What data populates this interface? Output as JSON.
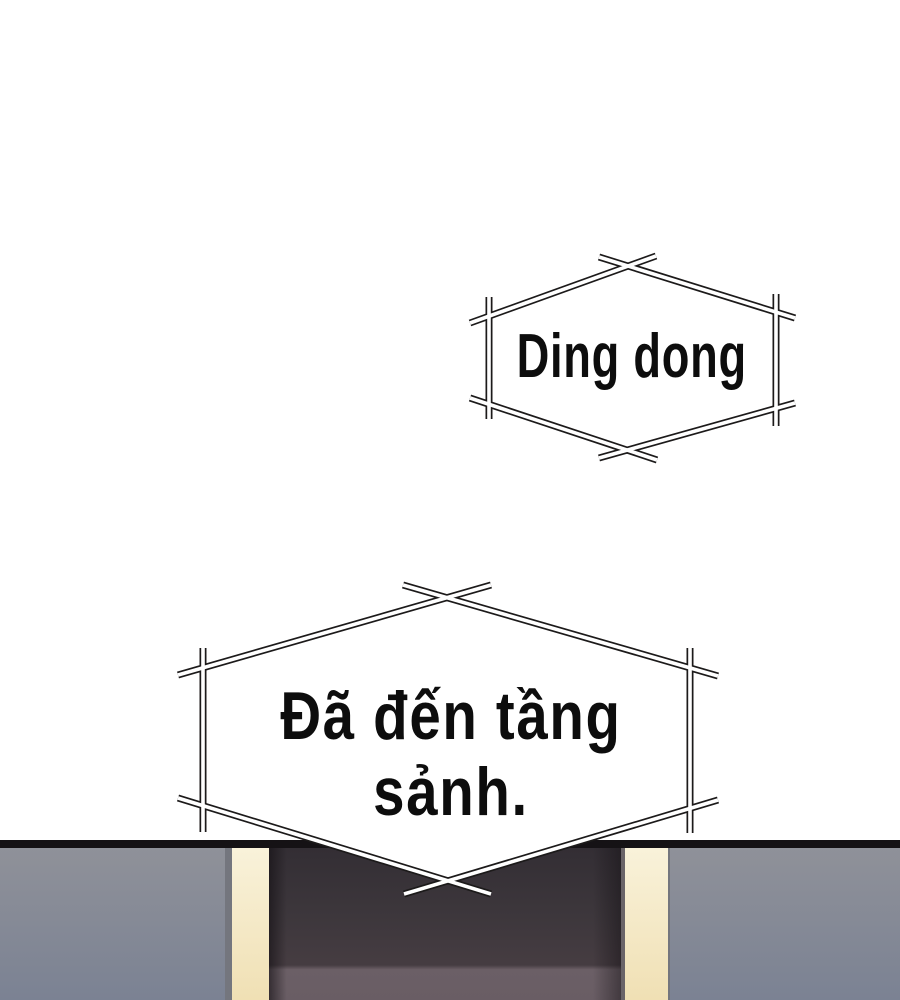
{
  "panel": {
    "kind": "webtoon-comic-panel",
    "background": "#ffffff"
  },
  "sfx_bubble": {
    "shape": "hexagon-stick-frame",
    "text": "Ding dong"
  },
  "caption_bubble": {
    "shape": "hexagon-stick-frame",
    "line1": "Đã đến tầng",
    "line2": "sảnh.",
    "full_text": "Đã đến tầng sảnh."
  },
  "scene": {
    "description_labels": [],
    "elements": [
      "lobby-wall-left",
      "door-frame-trim-left",
      "elevator-doorway",
      "door-frame-trim-right",
      "lobby-wall-right"
    ]
  },
  "theme": {
    "page_bg": "#ffffff",
    "ink": "#1c1a1a",
    "bubble_fill": "#ffffff",
    "text_color": "#0d0d0d",
    "divider": "#151215",
    "wall_top": "#8f9199",
    "wall_bottom": "#7b8293",
    "wall_edge": "#74767e",
    "trim_top": "#f9f2da",
    "trim_bottom": "#f0e0b4",
    "door_top": "#332e34",
    "door_mid": "#453c41",
    "door_bottom": "#6b5f66",
    "door_step": "#6a6468"
  }
}
